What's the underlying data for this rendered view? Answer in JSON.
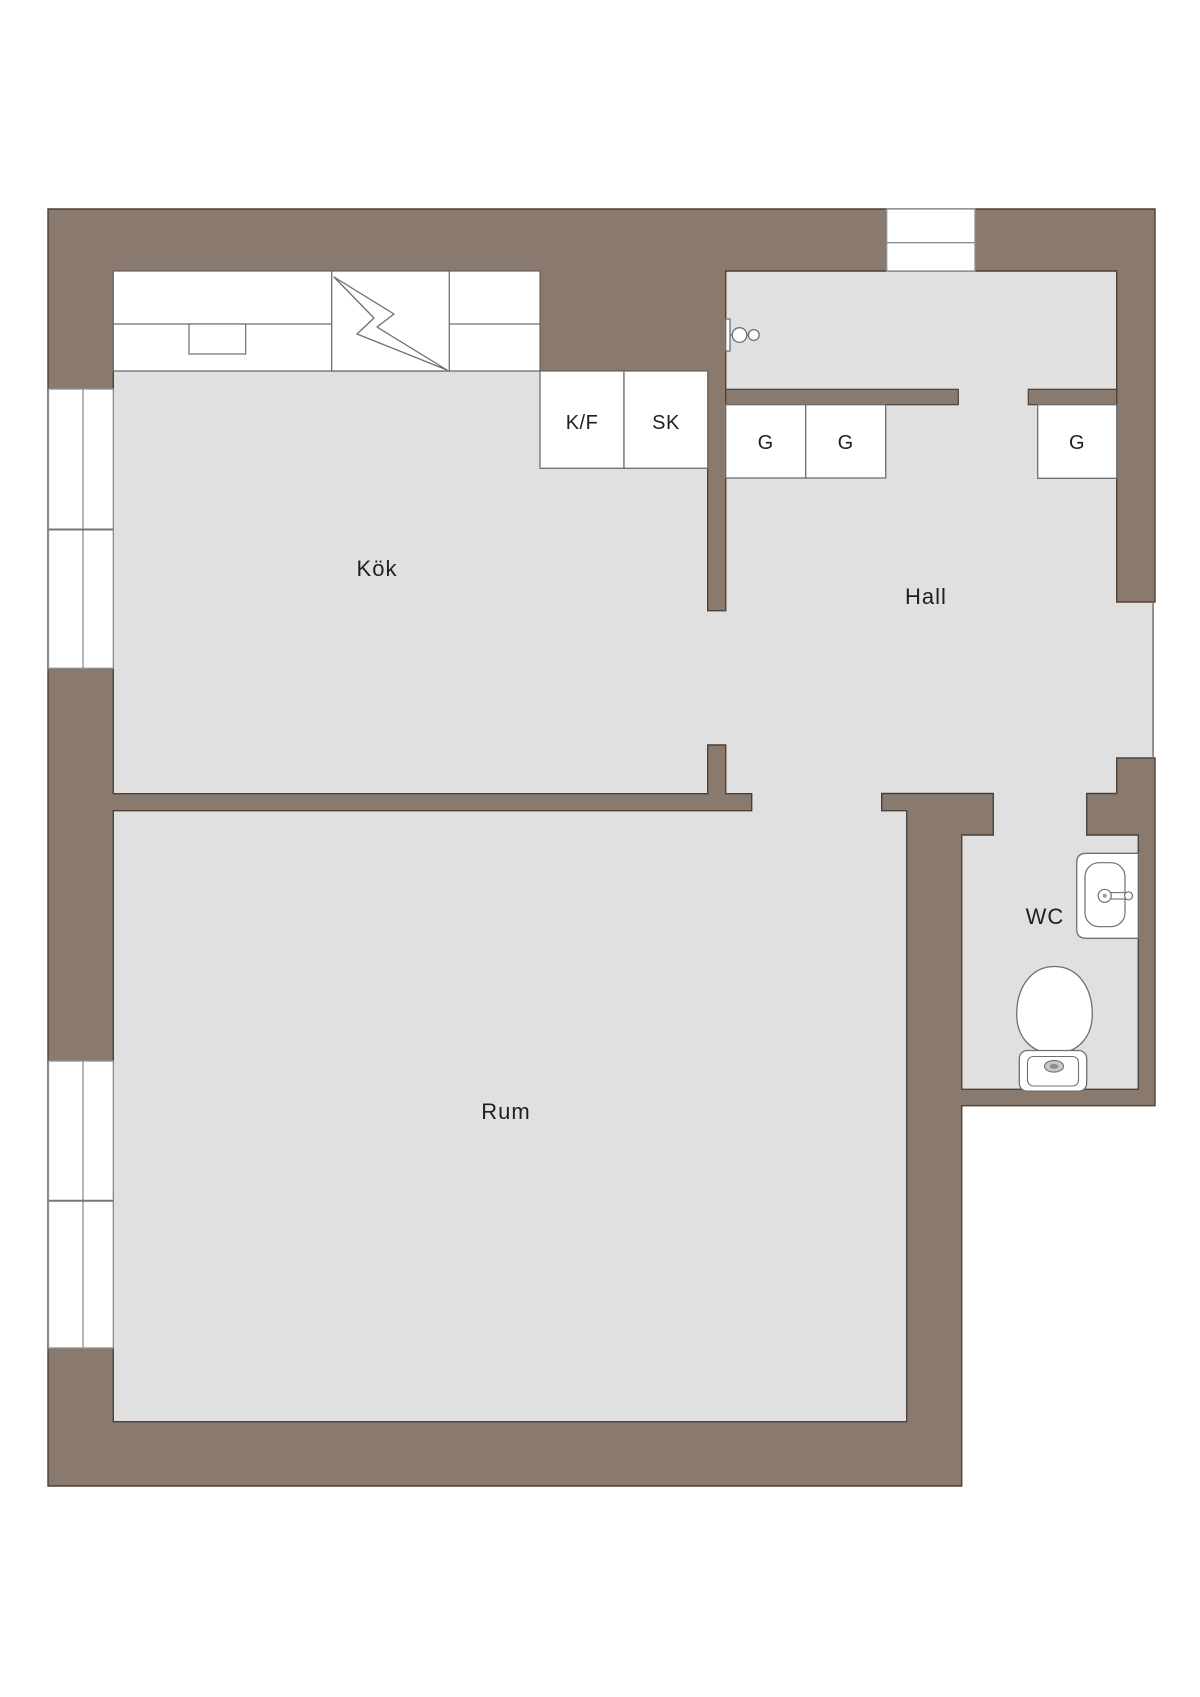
{
  "plan": {
    "title": "apartment-floor-plan",
    "rooms": {
      "kitchen": "Kök",
      "hall": "Hall",
      "room": "Rum",
      "wc": "WC"
    },
    "casework": {
      "fridge_freezer": "K/F",
      "cleaning_cabinet": "SK",
      "wardrobe_labels": [
        "G",
        "G",
        "G"
      ]
    },
    "icons": {
      "stove": "lightning-bolt-icon",
      "kitchen_sink": "sink-rect-icon",
      "door_handle": "door-handle-icon",
      "wc_sink": "washbasin-icon",
      "toilet": "toilet-icon",
      "entrance_door": "door-opening-icon",
      "windows": "double-line-window-icon"
    },
    "colors": {
      "wall": "#8a7a6e",
      "outline": "#4b413a",
      "floor": "#e0e0e0",
      "fixture_outline": "#6f6f6f",
      "window_line": "#8f8f8f",
      "text": "#1f1f1f",
      "background": "#ffffff"
    }
  }
}
